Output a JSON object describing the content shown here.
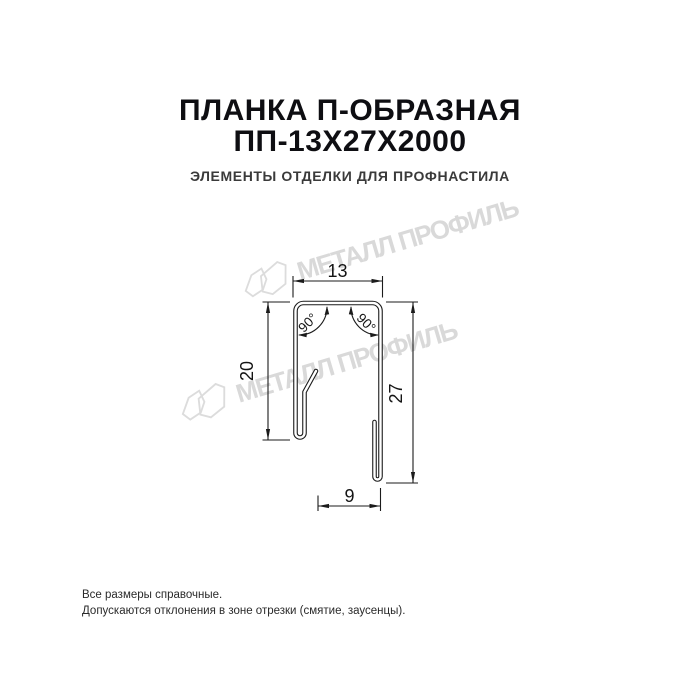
{
  "header": {
    "title_line1": "ПЛАНКА П-ОБРАЗНАЯ",
    "title_line2": "ПП-13Х27Х2000",
    "subtitle": "ЭЛЕМЕНТЫ ОТДЕЛКИ ДЛЯ ПРОФНАСТИЛА"
  },
  "watermark": {
    "text": "МЕТАЛЛ ПРОФИЛЬ",
    "logo_icon": "metall-profil-logo-icon",
    "color": "#d9d9d9"
  },
  "drawing": {
    "type": "technical-cross-section",
    "dimensions": {
      "top_width": "13",
      "left_height": "20",
      "right_height": "27",
      "bottom_width": "9",
      "angle_left": "90°",
      "angle_right": "90°"
    },
    "line_color": "#1b1b1b"
  },
  "footer": {
    "lines": [
      "Все размеры справочные.",
      "Допускаются отклонения в зоне отрезки (смятие, заусенцы)."
    ]
  },
  "colors": {
    "title": "#0e0e12",
    "subtitle": "#3a3a3a",
    "watermark": "#d9d9d9",
    "drawing_lines": "#1b1b1b",
    "background": "#ffffff"
  }
}
